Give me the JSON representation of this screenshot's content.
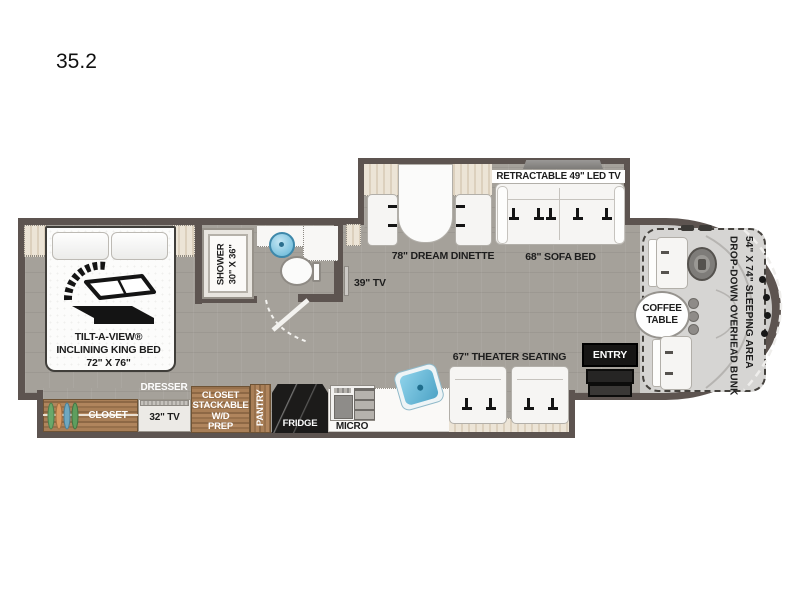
{
  "title": "35.2",
  "bedroom": {
    "bed_label_1": "TILT-A-VIEW®",
    "bed_label_2": "INCLINING KING BED",
    "bed_label_3": "72\" X 76\"",
    "closet_label": "CLOSET",
    "dresser_label": "DRESSER",
    "tv_label": "32\" TV",
    "wardrobe_closet_label": "CLOSET",
    "wd_label_1": "STACKABLE",
    "wd_label_2": "W/D",
    "wd_label_3": "PREP"
  },
  "bathroom": {
    "shower_label_1": "SHOWER",
    "shower_label_2": "30\" X 36\""
  },
  "living": {
    "tv_label": "39\" TV",
    "dinette_label": "78\" DREAM DINETTE",
    "retractable_tv_label": "RETRACTABLE 49\" LED TV",
    "sofa_label": "68\" SOFA BED",
    "theater_label": "67\" THEATER SEATING"
  },
  "kitchen": {
    "pantry_label": "PANTRY",
    "fridge_label": "FRIDGE",
    "micro_label": "MICRO"
  },
  "cab": {
    "entry_label": "ENTRY",
    "coffee_label_1": "COFFEE",
    "coffee_label_2": "TABLE",
    "bunk_label_1": "DROP-DOWN OVERHEAD BUNK",
    "bunk_label_2": "54\" X 74\" SLEEPING AREA"
  },
  "colors": {
    "wall": "#5d5450",
    "floor": "#a5a19a",
    "cab_floor": "#cecdcb",
    "wood": "#a97f57",
    "trim_cream": "#ece4d6",
    "sink_blue": "#62b7d8",
    "entry_black": "#161514",
    "white_furniture": "#f8f7f5"
  }
}
